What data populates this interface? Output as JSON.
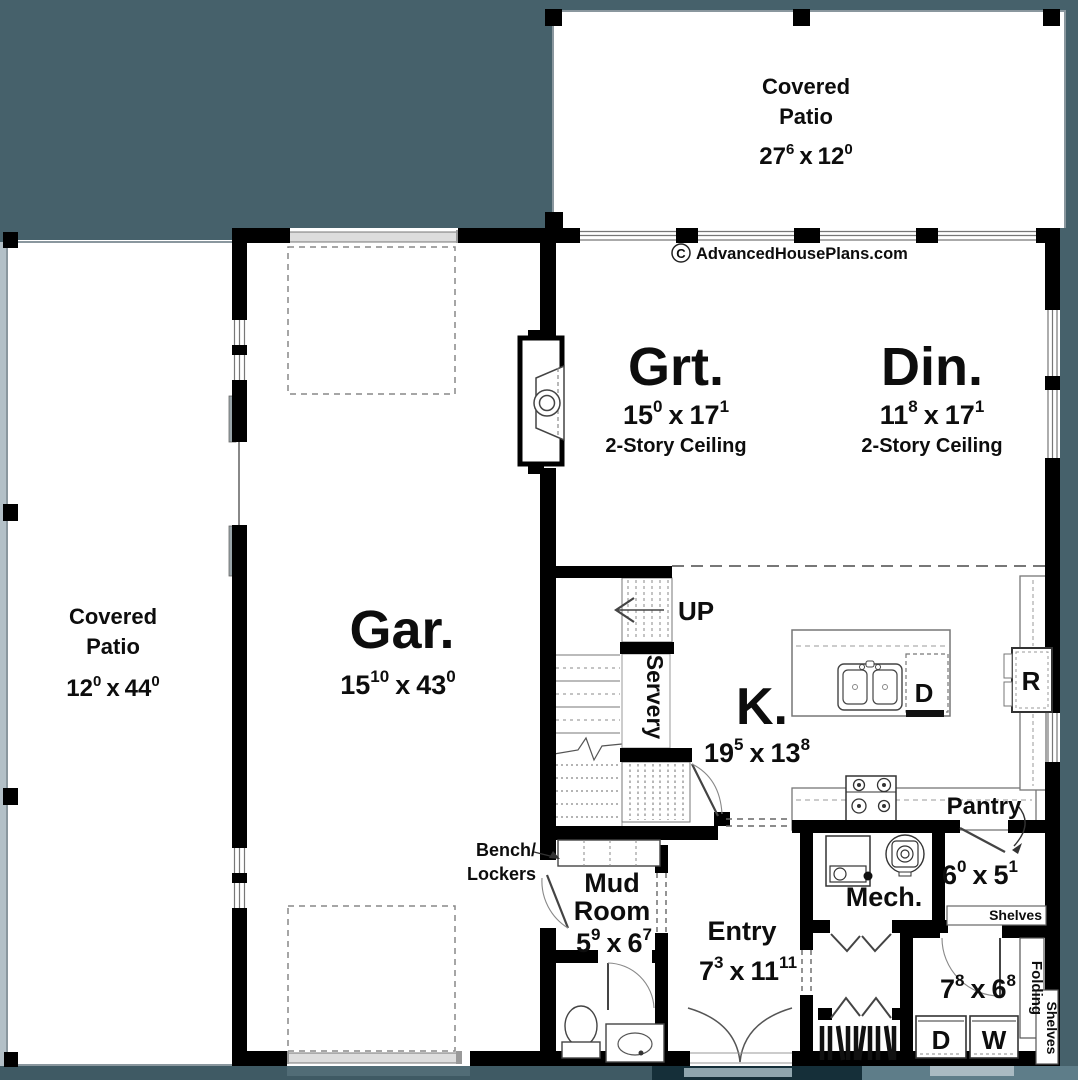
{
  "sep": "x",
  "watermark": {
    "symbol": "C",
    "text": "AdvancedHousePlans.com"
  },
  "colors": {
    "background": "#46616b",
    "wall": "#000000",
    "floor": "#ffffff"
  },
  "rooms": {
    "patio_top": {
      "line1": "Covered",
      "line2": "Patio",
      "dim": {
        "ft1": "27",
        "in1": "6",
        "ft2": "12",
        "in2": "0"
      }
    },
    "patio_left": {
      "line1": "Covered",
      "line2": "Patio",
      "dim": {
        "ft1": "12",
        "in1": "0",
        "ft2": "44",
        "in2": "0"
      }
    },
    "garage": {
      "label": "Gar.",
      "dim": {
        "ft1": "15",
        "in1": "10",
        "ft2": "43",
        "in2": "0"
      }
    },
    "great": {
      "label": "Grt.",
      "note": "2-Story Ceiling",
      "dim": {
        "ft1": "15",
        "in1": "0",
        "ft2": "17",
        "in2": "1"
      }
    },
    "dining": {
      "label": "Din.",
      "note": "2-Story Ceiling",
      "dim": {
        "ft1": "11",
        "in1": "8",
        "ft2": "17",
        "in2": "1"
      }
    },
    "kitchen": {
      "label": "K.",
      "dim": {
        "ft1": "19",
        "in1": "5",
        "ft2": "13",
        "in2": "8"
      }
    },
    "servery": {
      "label": "Servery"
    },
    "stairs": {
      "up": "UP"
    },
    "mud": {
      "line1": "Mud",
      "line2": "Room",
      "dim": {
        "ft1": "5",
        "in1": "9",
        "ft2": "6",
        "in2": "7"
      }
    },
    "bench": {
      "line1": "Bench/",
      "line2": "Lockers"
    },
    "entry": {
      "label": "Entry",
      "dim": {
        "ft1": "7",
        "in1": "3",
        "ft2": "11",
        "in2": "11"
      }
    },
    "mech": {
      "label": "Mech."
    },
    "pantry": {
      "label": "Pantry",
      "shelves": "Shelves",
      "dim": {
        "ft1": "6",
        "in1": "0",
        "ft2": "5",
        "in2": "1"
      }
    },
    "laundry": {
      "folding": "Folding",
      "shelves": "Shelves",
      "dryer": "D",
      "washer": "W",
      "dim": {
        "ft1": "7",
        "in1": "8",
        "ft2": "6",
        "in2": "8"
      }
    },
    "island": {
      "dishwasher": "D"
    },
    "fridge": {
      "label": "R"
    }
  }
}
